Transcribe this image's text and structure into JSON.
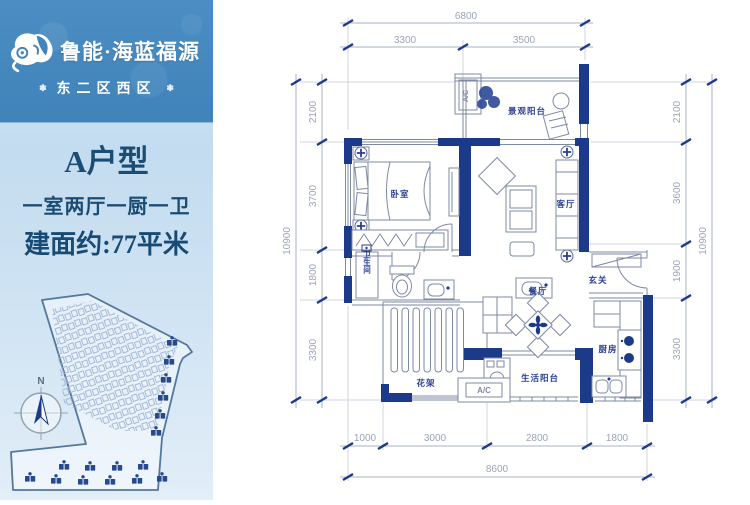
{
  "colors": {
    "wall_navy": "#1c3a8a",
    "brand_blue": "#4285bb",
    "title_blue": "#1b4c74",
    "dim_gray": "#9aa3b8"
  },
  "brand": {
    "icon": "cloud-swirl-logo",
    "name": "鲁能·海蓝福源",
    "subtitle": "东二区西区",
    "ornament": "❃"
  },
  "unit": {
    "title": "A户型",
    "layout": "一室两厅一厨一卫",
    "area": "建面约:77平米"
  },
  "site_map": {
    "north_label": "N"
  },
  "floor_plan": {
    "rooms": {
      "bedroom": "卧室",
      "living": "客厅",
      "dining": "餐厅",
      "entry": "玄关",
      "kitchen": "厨房",
      "bathroom": "卫生间",
      "view_balcony": "景观阳台",
      "service_balcony": "生活阳台",
      "pergola": "花架"
    },
    "ac_label": "A/C",
    "dims": {
      "top_total": "6800",
      "top_segments": [
        "3300",
        "3500"
      ],
      "bottom_total": "8600",
      "bottom_segments": [
        "1000",
        "3000",
        "2800",
        "1800"
      ],
      "left_total": "10900",
      "left_segments": [
        "2100",
        "3700",
        "1800",
        "3300"
      ],
      "right_total": "10900",
      "right_segments": [
        "2100",
        "3600",
        "1900",
        "3300"
      ]
    }
  }
}
